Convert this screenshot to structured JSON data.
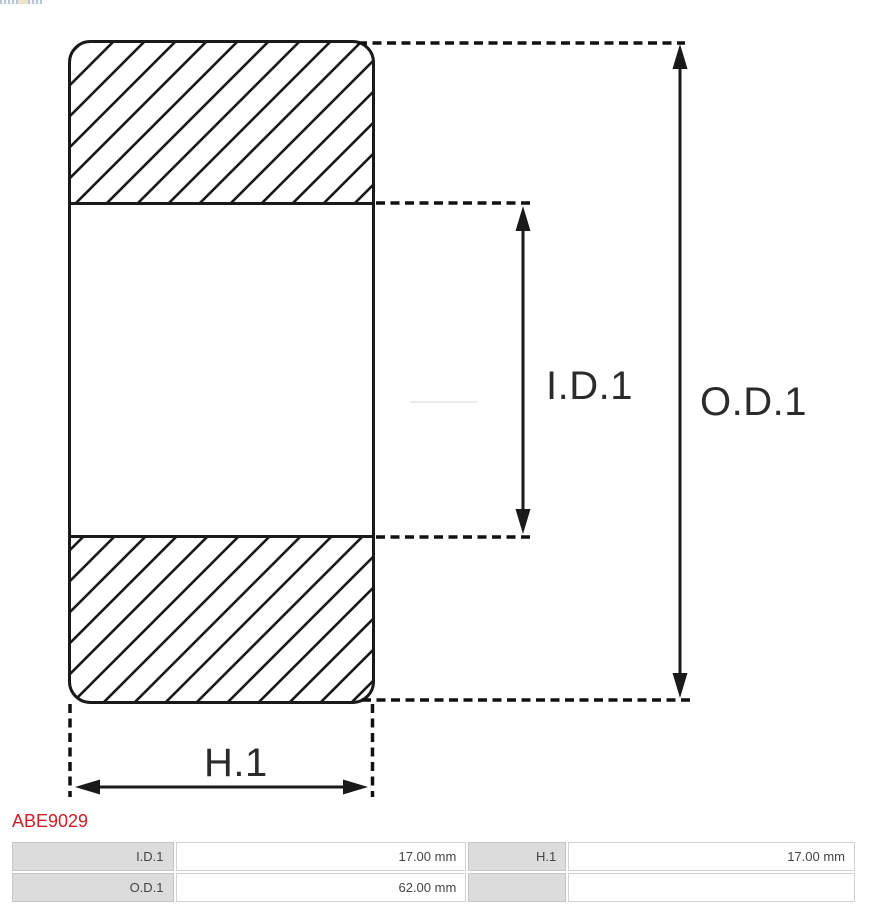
{
  "product_code": "ABE9029",
  "diagram": {
    "type": "bearing-cross-section",
    "id_label": "I.D.1",
    "od_label": "O.D.1",
    "h_label": "H.1"
  },
  "dimensions_table": {
    "rows": [
      {
        "cells": [
          {
            "label": "I.D.1",
            "value": "17.00 mm"
          },
          {
            "label": "H.1",
            "value": "17.00 mm"
          }
        ]
      },
      {
        "cells": [
          {
            "label": "O.D.1",
            "value": "62.00 mm"
          },
          {
            "label": "",
            "value": ""
          }
        ]
      }
    ]
  },
  "colors": {
    "accent_red": "#cb2026",
    "drawing_line": "#1a1a1a",
    "table_label_bg": "#dcdcdc",
    "table_border": "#c6c6c6",
    "table_text": "#444444"
  }
}
